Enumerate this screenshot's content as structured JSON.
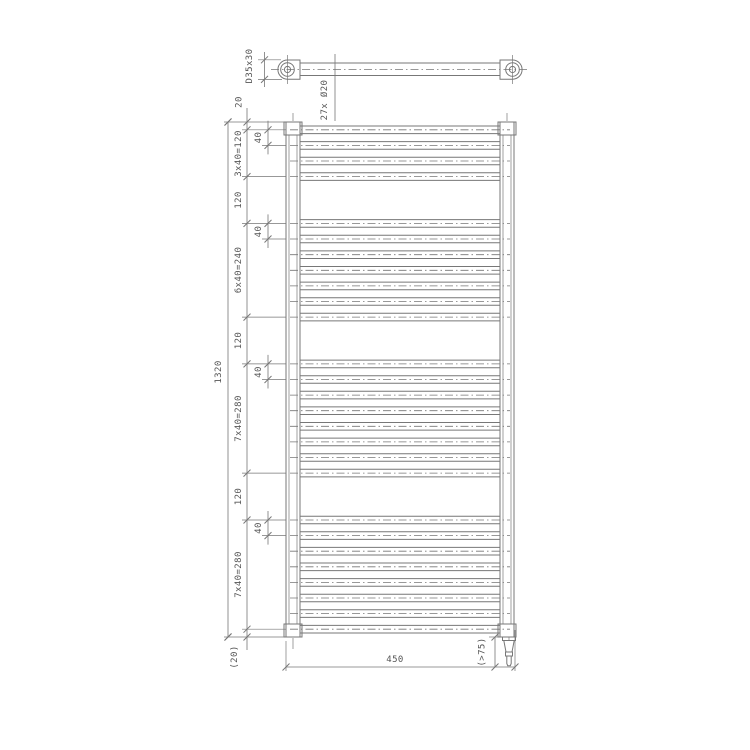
{
  "labels": {
    "overall_height": "1320",
    "width": "450",
    "top_offset": "20",
    "bottom_offset": "(20)",
    "clearance": "(>75)",
    "collector_profile": "D35x30",
    "tube_spec": "27x Ø20",
    "spacing_40": "40",
    "segments": [
      "3x40=120",
      "120",
      "6x40=240",
      "120",
      "7x40=280",
      "120",
      "7x40=280"
    ]
  },
  "radiator": {
    "type": "ladder towel radiator, front view and top view",
    "height_mm": 1320,
    "width_mm": 450,
    "tube_diameter_mm": 20,
    "tube_count": 27,
    "collector_profile_mm": "D35x30",
    "tube_groups": [
      {
        "tubes": 4,
        "start_mm": 20,
        "pitch_mm": 40
      },
      {
        "tubes": 7,
        "start_mm": 260,
        "pitch_mm": 40
      },
      {
        "tubes": 8,
        "start_mm": 620,
        "pitch_mm": 40
      },
      {
        "tubes": 8,
        "start_mm": 1020,
        "pitch_mm": 40
      }
    ]
  },
  "colors": {
    "line": "#777777",
    "thin_line": "#8a8a8a",
    "text": "#555555",
    "background": "#ffffff"
  }
}
